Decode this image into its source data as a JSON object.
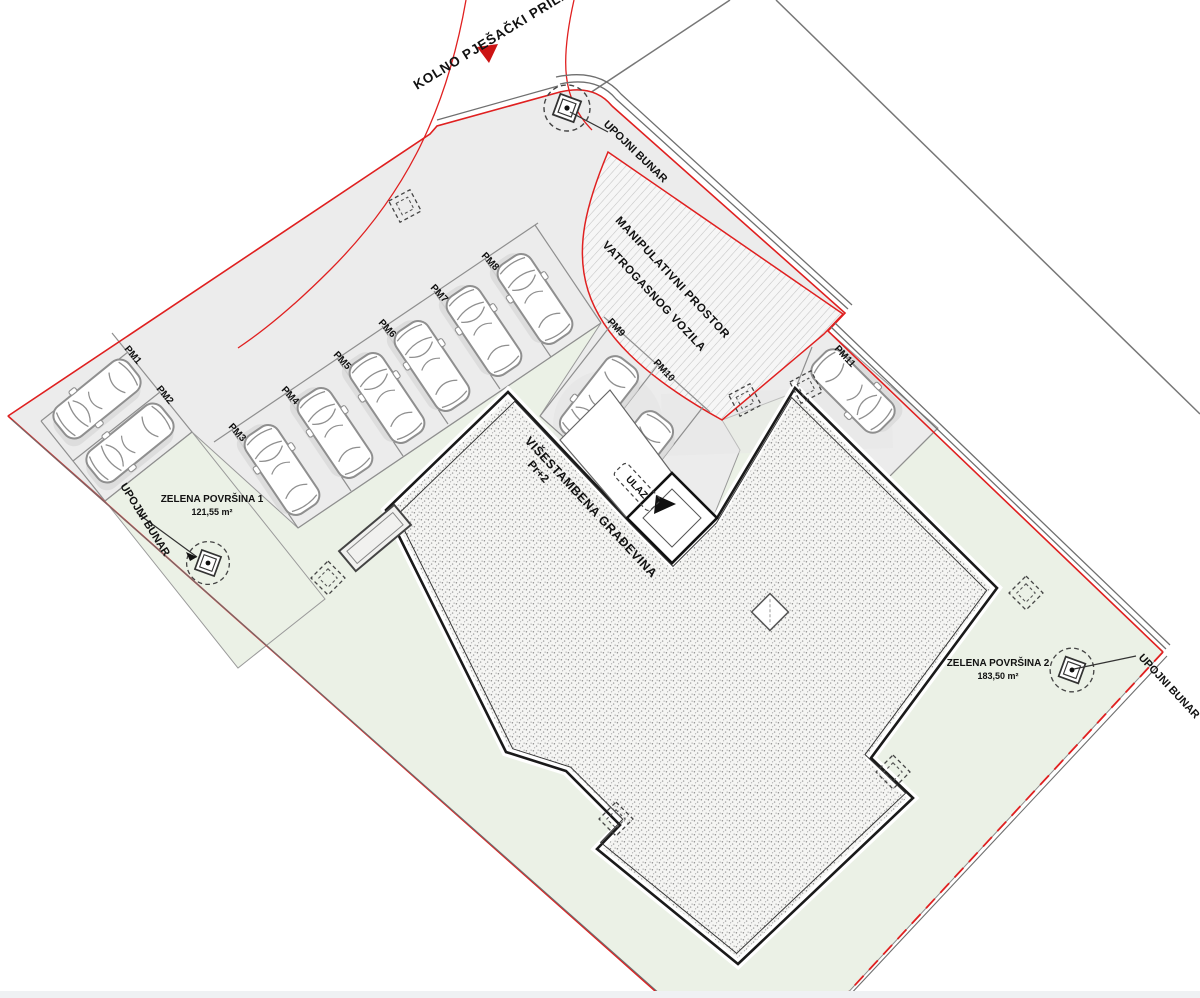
{
  "site_plan": {
    "labels": {
      "access_road": "KOLNO PJEŠAČKI PRILAZ",
      "fire_truck_area_line1": "MANIPULATIVNI PROSTOR",
      "fire_truck_area_line2": "VATROGASNOG VOZILA",
      "building_line1": "VIŠESTAMBENA GRAĐEVINA",
      "building_line2": "Pr+2",
      "entrance": "ULAZ",
      "well": "UPOJNI BUNAR"
    },
    "green_areas": [
      {
        "name": "ZELENA POVRŠINA 1",
        "area": "121,55 m²"
      },
      {
        "name": "ZELENA POVRŠINA 2",
        "area": "183,50 m²"
      }
    ],
    "parking_spots": [
      "PM1",
      "PM2",
      "PM3",
      "PM4",
      "PM5",
      "PM6",
      "PM7",
      "PM8",
      "PM9",
      "PM10",
      "PM11"
    ],
    "colors": {
      "boundary_red": "#e02020",
      "green_fill": "#ebf1e6",
      "paved_fill": "#ececec",
      "building_fill": "#f5f5f3",
      "line_gray": "#8f8f8f",
      "outline_black": "#1a1a1a"
    }
  }
}
